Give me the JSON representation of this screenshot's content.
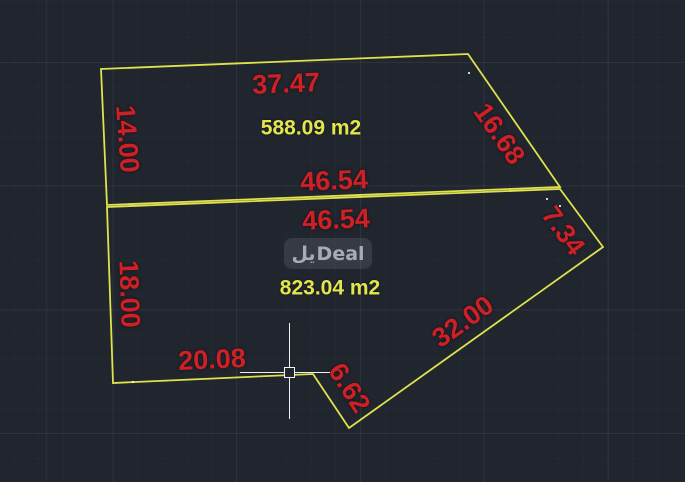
{
  "canvas": {
    "width": 685,
    "height": 482,
    "background_color": "#20252e",
    "outline_color": "#dfe24d",
    "dim_text_color": "#cd2128",
    "area_text_color": "#e3e64b"
  },
  "watermark": {
    "text_ar": "يل",
    "text_en": "Deal"
  },
  "parcels": [
    {
      "id": "upper-parcel",
      "points": [
        [
          101,
          69
        ],
        [
          468,
          54
        ],
        [
          560,
          187
        ],
        [
          107,
          205
        ]
      ],
      "area_label": {
        "text": "588.09 m2",
        "x": 311,
        "y": 128
      }
    },
    {
      "id": "lower-parcel",
      "points": [
        [
          107,
          207
        ],
        [
          560,
          189
        ],
        [
          603,
          247
        ],
        [
          349,
          428
        ],
        [
          313,
          374
        ],
        [
          113,
          383
        ]
      ],
      "area_label": {
        "text": "823.04 m2",
        "x": 330,
        "y": 288
      }
    }
  ],
  "dimensions": [
    {
      "text": "37.47",
      "x": 286,
      "y": 84,
      "rot": -2.3
    },
    {
      "text": "14.00",
      "x": 127,
      "y": 139,
      "rot": 86
    },
    {
      "text": "16.68",
      "x": 499,
      "y": 134,
      "rot": 55
    },
    {
      "text": "46.54",
      "x": 334,
      "y": 181,
      "rot": -2.3
    },
    {
      "text": "46.54",
      "x": 336,
      "y": 220,
      "rot": -2.3
    },
    {
      "text": "7.34",
      "x": 563,
      "y": 231,
      "rot": 54
    },
    {
      "text": "18.00",
      "x": 129,
      "y": 294,
      "rot": 88
    },
    {
      "text": "32.00",
      "x": 463,
      "y": 322,
      "rot": -35.5
    },
    {
      "text": "20.08",
      "x": 212,
      "y": 360,
      "rot": -2.6
    },
    {
      "text": "6.62",
      "x": 349,
      "y": 388,
      "rot": 57
    }
  ],
  "crosshair": {
    "x": 289.5,
    "y": 372.5,
    "h_start": 240,
    "h_end": 330,
    "v_start": 323,
    "v_end": 419,
    "pickbox_size": 11
  },
  "point_markers": [
    [
      469,
      73
    ],
    [
      547,
      199
    ],
    [
      560,
      206
    ],
    [
      133,
      382
    ]
  ]
}
